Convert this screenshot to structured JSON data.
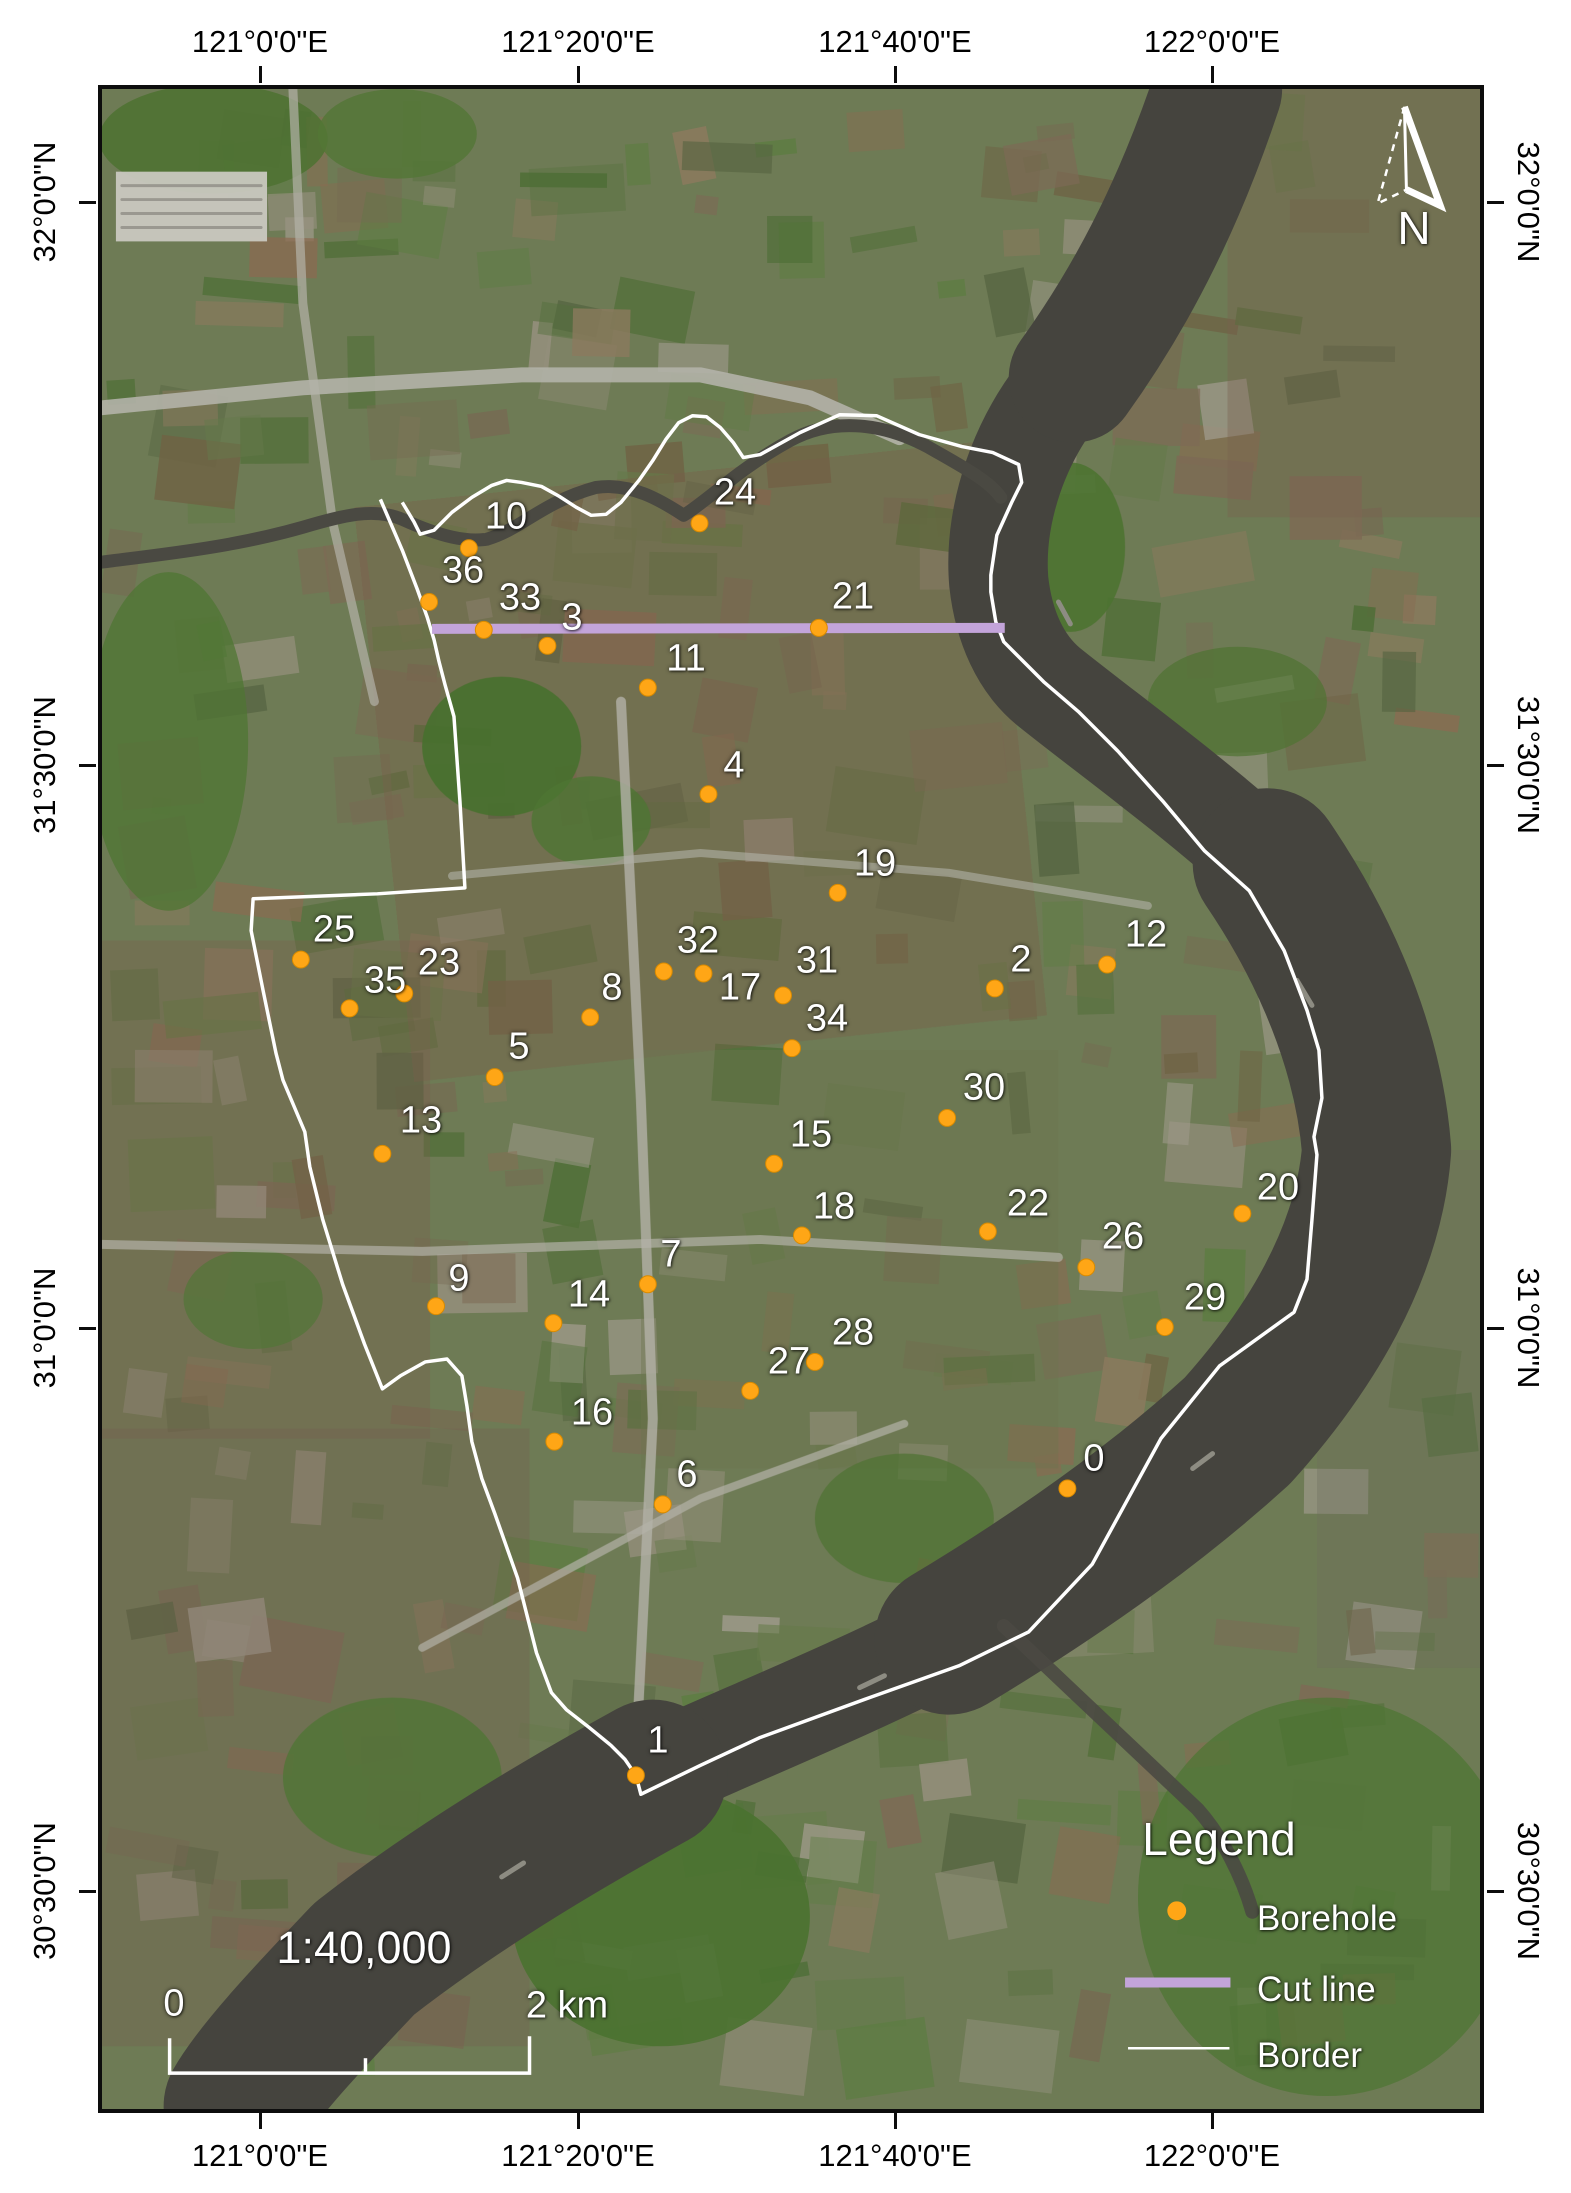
{
  "axis": {
    "top": [
      {
        "label": "121°0'0\"E",
        "x": 260
      },
      {
        "label": "121°20'0\"E",
        "x": 578
      },
      {
        "label": "121°40'0\"E",
        "x": 895
      },
      {
        "label": "122°0'0\"E",
        "x": 1212
      }
    ],
    "bottom": [
      {
        "label": "121°0'0\"E",
        "x": 260
      },
      {
        "label": "121°20'0\"E",
        "x": 578
      },
      {
        "label": "121°40'0\"E",
        "x": 895
      },
      {
        "label": "122°0'0\"E",
        "x": 1212
      }
    ],
    "left": [
      {
        "label": "32°0'0\"N",
        "y": 202
      },
      {
        "label": "31°30'0\"N",
        "y": 765
      },
      {
        "label": "31°0'0\"N",
        "y": 1328
      },
      {
        "label": "30°30'0\"N",
        "y": 1891
      }
    ],
    "right": [
      {
        "label": "32°0'0\"N",
        "y": 202
      },
      {
        "label": "31°30'0\"N",
        "y": 765
      },
      {
        "label": "31°0'0\"N",
        "y": 1328
      },
      {
        "label": "30°30'0\"N",
        "y": 1891
      }
    ]
  },
  "boreholes": [
    {
      "n": "0",
      "x": 1069,
      "y": 1490,
      "lx": 1090,
      "ly": 1455
    },
    {
      "n": "1",
      "x": 635,
      "y": 1778,
      "lx": 654,
      "ly": 1737
    },
    {
      "n": "2",
      "x": 996,
      "y": 988,
      "lx": 1017,
      "ly": 956
    },
    {
      "n": "3",
      "x": 546,
      "y": 644,
      "lx": 568,
      "ly": 614
    },
    {
      "n": "4",
      "x": 708,
      "y": 793,
      "lx": 730,
      "ly": 762
    },
    {
      "n": "5",
      "x": 493,
      "y": 1077,
      "lx": 515,
      "ly": 1043
    },
    {
      "n": "6",
      "x": 662,
      "y": 1506,
      "lx": 683,
      "ly": 1471
    },
    {
      "n": "7",
      "x": 647,
      "y": 1285,
      "lx": 667,
      "ly": 1251
    },
    {
      "n": "8",
      "x": 589,
      "y": 1017,
      "lx": 608,
      "ly": 984
    },
    {
      "n": "9",
      "x": 434,
      "y": 1307,
      "lx": 455,
      "ly": 1275
    },
    {
      "n": "10",
      "x": 467,
      "y": 546,
      "lx": 502,
      "ly": 513
    },
    {
      "n": "11",
      "x": 647,
      "y": 686,
      "lx": 682,
      "ly": 655
    },
    {
      "n": "12",
      "x": 1109,
      "y": 964,
      "lx": 1142,
      "ly": 931
    },
    {
      "n": "13",
      "x": 380,
      "y": 1154,
      "lx": 417,
      "ly": 1117
    },
    {
      "n": "14",
      "x": 552,
      "y": 1324,
      "lx": 585,
      "ly": 1291
    },
    {
      "n": "15",
      "x": 774,
      "y": 1164,
      "lx": 807,
      "ly": 1131
    },
    {
      "n": "16",
      "x": 553,
      "y": 1443,
      "lx": 588,
      "ly": 1409
    },
    {
      "n": "17",
      "x": 703,
      "y": 973,
      "lx": 736,
      "ly": 984
    },
    {
      "n": "18",
      "x": 802,
      "y": 1236,
      "lx": 830,
      "ly": 1203
    },
    {
      "n": "19",
      "x": 838,
      "y": 892,
      "lx": 871,
      "ly": 860
    },
    {
      "n": "20",
      "x": 1245,
      "y": 1214,
      "lx": 1274,
      "ly": 1184
    },
    {
      "n": "21",
      "x": 819,
      "y": 626,
      "lx": 849,
      "ly": 593
    },
    {
      "n": "22",
      "x": 989,
      "y": 1232,
      "lx": 1024,
      "ly": 1200
    },
    {
      "n": "23",
      "x": 402,
      "y": 993,
      "lx": 435,
      "ly": 959
    },
    {
      "n": "24",
      "x": 699,
      "y": 521,
      "lx": 731,
      "ly": 489
    },
    {
      "n": "25",
      "x": 298,
      "y": 959,
      "lx": 330,
      "ly": 926
    },
    {
      "n": "26",
      "x": 1088,
      "y": 1268,
      "lx": 1119,
      "ly": 1233
    },
    {
      "n": "27",
      "x": 750,
      "y": 1392,
      "lx": 785,
      "ly": 1358
    },
    {
      "n": "28",
      "x": 815,
      "y": 1363,
      "lx": 849,
      "ly": 1329
    },
    {
      "n": "29",
      "x": 1167,
      "y": 1328,
      "lx": 1201,
      "ly": 1294
    },
    {
      "n": "30",
      "x": 948,
      "y": 1118,
      "lx": 980,
      "ly": 1084
    },
    {
      "n": "31",
      "x": 783,
      "y": 995,
      "lx": 813,
      "ly": 957
    },
    {
      "n": "32",
      "x": 663,
      "y": 971,
      "lx": 694,
      "ly": 937
    },
    {
      "n": "33",
      "x": 482,
      "y": 628,
      "lx": 516,
      "ly": 594
    },
    {
      "n": "34",
      "x": 792,
      "y": 1048,
      "lx": 823,
      "ly": 1015
    },
    {
      "n": "35",
      "x": 347,
      "y": 1008,
      "lx": 381,
      "ly": 977
    },
    {
      "n": "36",
      "x": 427,
      "y": 600,
      "lx": 459,
      "ly": 567
    }
  ],
  "borehole_style": {
    "color": "#ffa616",
    "edge": "#d88a00",
    "radius": 8.5
  },
  "cut_line": {
    "x1": 430,
    "y1": 627,
    "x2": 1006,
    "y2": 626,
    "color": "#c3a4da",
    "width": 10
  },
  "border_line": {
    "color": "#ffffff",
    "width": 3.5,
    "points": "378,497 400,548 415,587 425,615 432,638 437,660 443,683 452,715 458,800 463,887 375,893 250,898 248,930 260,990 273,1053 280,1080 302,1132 307,1167 320,1220 340,1285 362,1345 380,1390 398,1377 423,1363 445,1360 460,1377 465,1407 470,1443 480,1480 493,1515 516,1580 535,1655 550,1695 565,1712 588,1730 610,1748 624,1762 635,1778 640,1797 700,1768 760,1740 870,1700 960,1668 1030,1634 1094,1566 1134,1493 1163,1440 1222,1367 1297,1313 1310,1280 1315,1220 1320,1155 1317,1137 1325,1098 1322,1050 1310,1010 1287,950 1252,890 1207,850 1165,800 1120,750 1080,710 1045,680 1018,653 1005,640 997,620 992,590 992,573 998,533 1013,500 1023,480 1020,462 994,450 963,444 920,432 877,413 840,412 800,430 760,452 743,455 733,440 720,425 706,414 692,413 678,420 665,437 652,458 638,478 620,500 605,512 590,513 575,505 558,494 540,484 520,480 505,478 490,483 470,495 450,510 432,528 418,532 412,520 400,500"
  },
  "legend": {
    "title": "Legend",
    "title_x": 1215,
    "title_y": 1835,
    "items": [
      {
        "key": "borehole",
        "label": "Borehole",
        "swatch": "dot",
        "sx": 1179,
        "sy": 1914,
        "tx": 1253,
        "ty": 1915
      },
      {
        "key": "cutline",
        "label": "Cut line",
        "swatch": "thick",
        "sx": 1180,
        "sy": 1986,
        "tx": 1253,
        "ty": 1986
      },
      {
        "key": "border",
        "label": "Border",
        "swatch": "thin",
        "sx": 1181,
        "sy": 2052,
        "tx": 1253,
        "ty": 2052
      }
    ]
  },
  "scale_bar": {
    "ratio_text": "1:40,000",
    "ratio_x": 360,
    "ratio_y": 1944,
    "zero_label": "0",
    "zero_x": 170,
    "zero_y": 2000,
    "end_label": "2 km",
    "end_x": 563,
    "end_y": 2002,
    "bar_x1": 166,
    "bar_x2": 528,
    "bar_mid": 363,
    "bar_y": 2077
  },
  "north_arrow": {
    "label": "N",
    "x": 1410,
    "y": 224
  }
}
